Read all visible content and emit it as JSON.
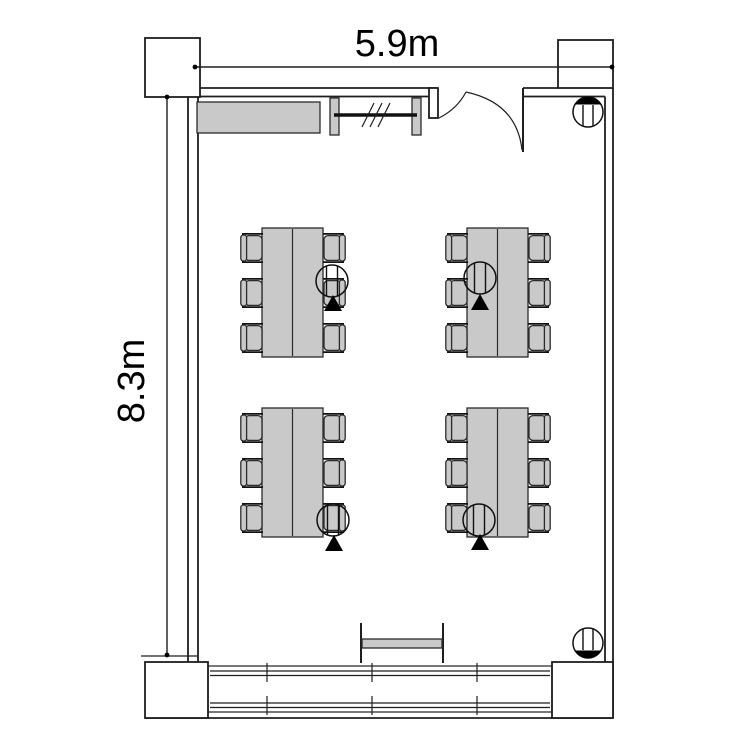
{
  "document": {
    "type": "architectural-floor-plan",
    "title": "Meeting room floor plan"
  },
  "dimensions": {
    "width_label": "5.9m",
    "depth_label": "8.3m",
    "width_m": 5.9,
    "depth_m": 8.3
  },
  "colors": {
    "background": "#ffffff",
    "line": "#1e1e1e",
    "furniture_fill": "#c9c9c9",
    "marker": "#000000"
  },
  "features": {
    "door": {
      "name": "entrance-door",
      "position": "top-right",
      "type": "inward-swing"
    },
    "whiteboard": {
      "name": "wall-mounted-whiteboard",
      "position": "top-wall-center",
      "hatch_marks": 3
    },
    "counter": {
      "name": "counter-cabinet",
      "position": "top-left-wall"
    },
    "window_wall": {
      "name": "window-wall",
      "position": "bottom-wall",
      "mullion_ticks": 3,
      "rails": 2
    },
    "console_table": {
      "name": "console-table",
      "position": "bottom-center"
    },
    "corner_symbols": [
      {
        "name": "column-utility-symbol",
        "position": "top-right-corner",
        "filled_segment": "top"
      },
      {
        "name": "column-utility-symbol",
        "position": "bottom-right-corner",
        "filled_segment": "bottom"
      }
    ]
  },
  "furniture": {
    "table_groups": [
      {
        "id": 1,
        "position": "top-left",
        "seats": 6,
        "floor_outlet_symbol": true,
        "marker": "black-triangle",
        "outlet_side": "right-middle"
      },
      {
        "id": 2,
        "position": "top-right",
        "seats": 6,
        "floor_outlet_symbol": true,
        "marker": "black-triangle",
        "outlet_side": "left-middle"
      },
      {
        "id": 3,
        "position": "bottom-left",
        "seats": 6,
        "floor_outlet_symbol": true,
        "marker": "black-triangle",
        "outlet_side": "right-bottom"
      },
      {
        "id": 4,
        "position": "bottom-right",
        "seats": 6,
        "floor_outlet_symbol": true,
        "marker": "black-triangle",
        "outlet_side": "left-bottom"
      }
    ],
    "chairs_per_side": 3,
    "total_seats": 24
  }
}
